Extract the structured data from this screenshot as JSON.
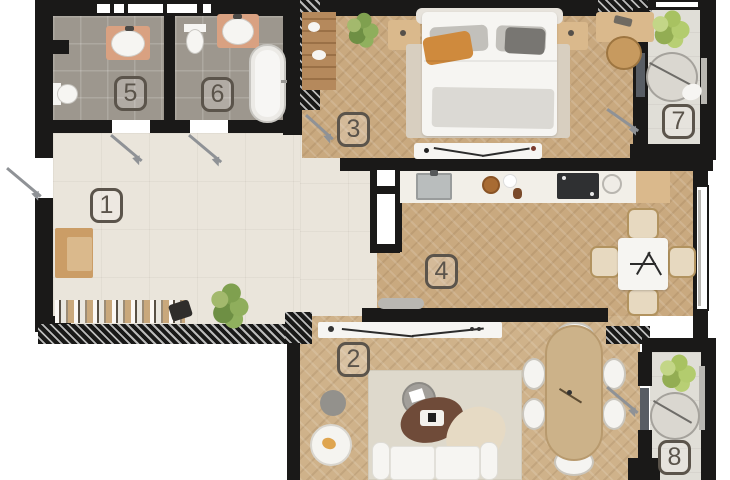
{
  "plan_type": "apartment-floor-plan",
  "rooms": [
    {
      "number": "1",
      "kind": "hallway"
    },
    {
      "number": "2",
      "kind": "living-room"
    },
    {
      "number": "3",
      "kind": "bedroom"
    },
    {
      "number": "4",
      "kind": "kitchen-dining-room"
    },
    {
      "number": "5",
      "kind": "bathroom"
    },
    {
      "number": "6",
      "kind": "bathroom-with-tub"
    },
    {
      "number": "7",
      "kind": "balcony"
    },
    {
      "number": "8",
      "kind": "balcony"
    }
  ],
  "colors": {
    "wall": "#1a1918",
    "wood_floor": "#c9a97f",
    "hall_floor": "#eae5db",
    "tile_floor": "#9d978e",
    "balcony_floor": "#e0ded7",
    "furniture_wood": "#cb9d66",
    "badge_outline": "#5b544b",
    "plant_green": "#7c9c4e",
    "accent_pillow": "#cf8a3d",
    "coffee_table_brown": "#6f4b39"
  }
}
